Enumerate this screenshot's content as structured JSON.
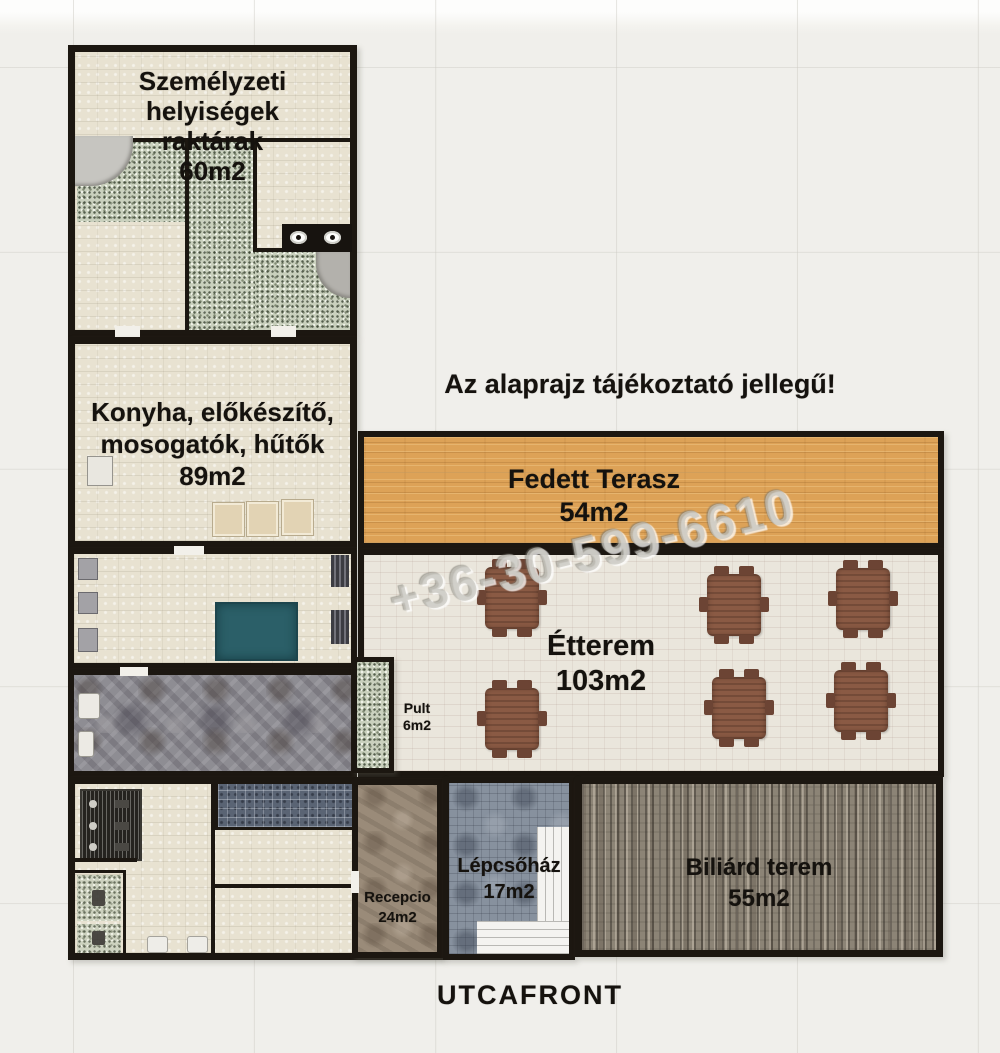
{
  "disclaimer": "Az alaprajz tájékoztató jellegű!",
  "watermark_phone": "+36-30-599-6610",
  "street_front_label": "UTCAFRONT",
  "rooms": {
    "staff": {
      "lines": [
        "Személyzeti",
        "helyiségek",
        "raktárak"
      ],
      "area": "60m2"
    },
    "kitchen": {
      "lines": [
        "Konyha, előkészítő,",
        "mosogatók, hűtők"
      ],
      "area": "89m2"
    },
    "terrace": {
      "name": "Fedett Terasz",
      "area": "54m2"
    },
    "restaurant": {
      "name": "Étterem",
      "area": "103m2"
    },
    "counter": {
      "name": "Pult",
      "area": "6m2"
    },
    "reception": {
      "name": "Recepcio",
      "area": "24m2"
    },
    "staircase": {
      "name": "Lépcsőház",
      "area": "17m2"
    },
    "billiard": {
      "name": "Biliárd terem",
      "area": "55m2"
    }
  },
  "colors": {
    "wall": "#1c1711",
    "canvas_bg": "#f0efeb",
    "beige": "#e8e2d1",
    "green": "#c9d0bd",
    "terrace": "#dda257",
    "cream": "#eae6dc",
    "corridor": "#8e8d93",
    "stairwell": "#87919e",
    "billiard": "#8c8476",
    "reception": "#9a8b79",
    "tiled_blue": "#5a6474",
    "teal": "#2b5f68",
    "table_brown": "#8a5a44"
  }
}
